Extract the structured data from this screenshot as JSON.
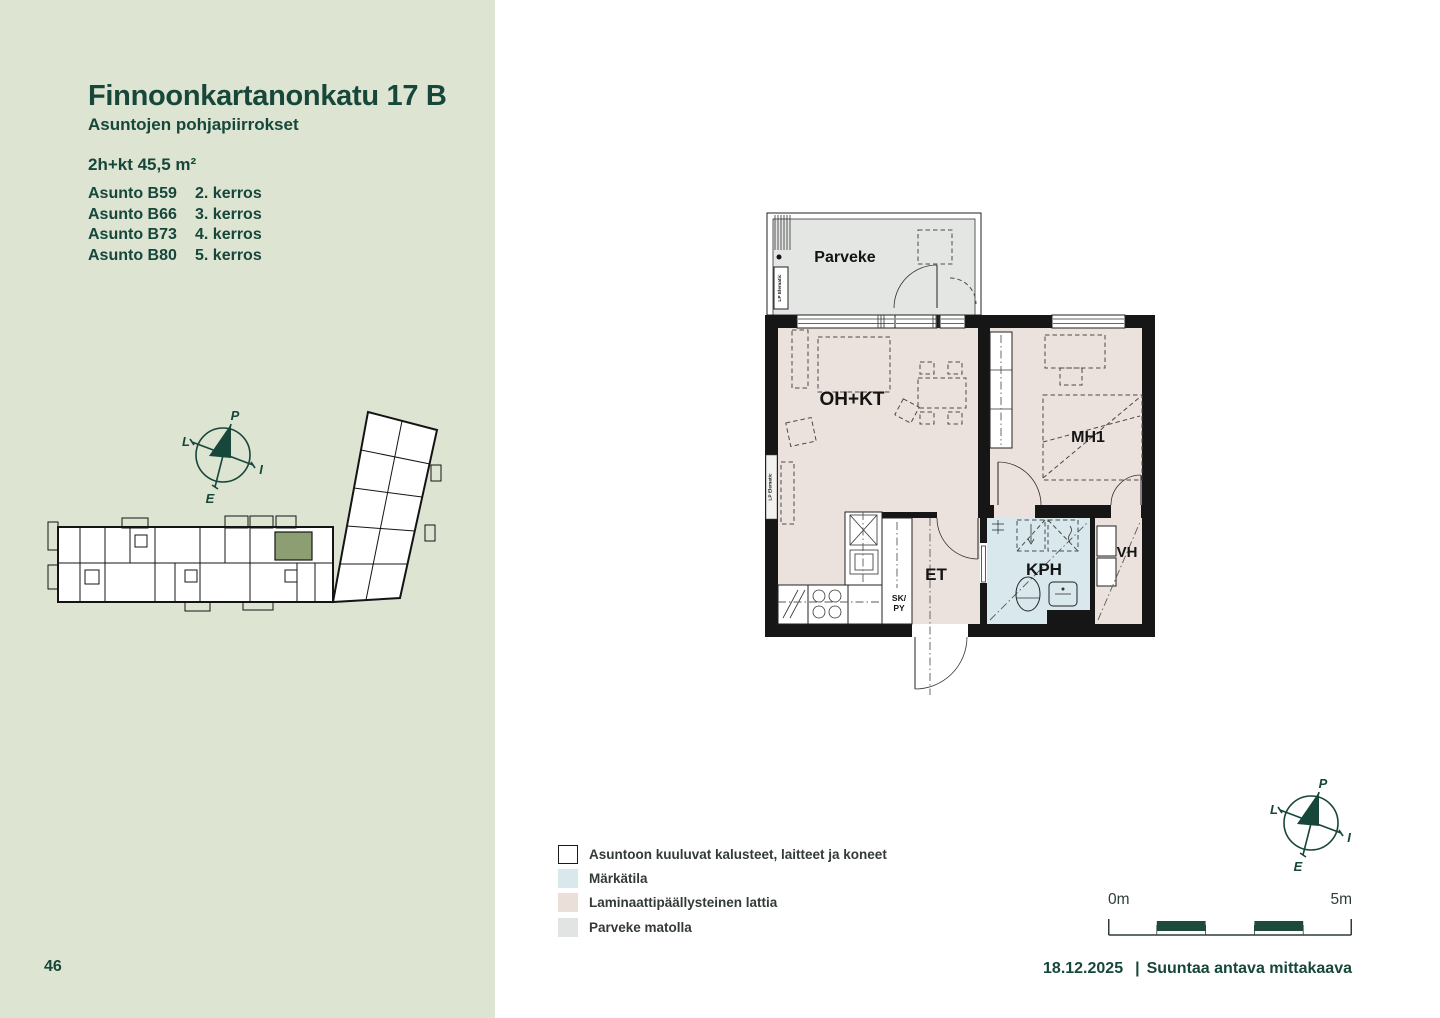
{
  "page": {
    "number": "46",
    "date": "18.12.2025",
    "separator": "|",
    "scale_note": "Suuntaa antava mittakaava"
  },
  "sidebar": {
    "title": "Finnoonkartanonkatu 17 B",
    "subtitle": "Asuntojen pohjapiirrokset",
    "apartment_type": "2h+kt 45,5 m²",
    "apartments": [
      {
        "name": "Asunto B59",
        "floor": "2. kerros"
      },
      {
        "name": "Asunto B66",
        "floor": "3. kerros"
      },
      {
        "name": "Asunto B73",
        "floor": "4. kerros"
      },
      {
        "name": "Asunto B80",
        "floor": "5. kerros"
      }
    ]
  },
  "floorplan": {
    "rooms": {
      "parveke": "Parveke",
      "oh_kt": "OH+KT",
      "mh1": "MH1",
      "et": "ET",
      "kph": "KPH",
      "vh": "VH",
      "sk": "SK/",
      "py": "PY"
    },
    "element_label": "LP Elematic"
  },
  "compass": {
    "north": "P",
    "west": "L",
    "east": "I",
    "south": "E"
  },
  "scalebar": {
    "start": "0m",
    "end": "5m"
  },
  "legend": {
    "items": [
      {
        "label": "Asuntoon kuuluvat kalusteet, laitteet ja koneet",
        "swatch": "#ffffff"
      },
      {
        "label": "Märkätila",
        "swatch": "#d8e8ec"
      },
      {
        "label": "Laminaattipäällysteinen lattia",
        "swatch": "#eadfd9"
      },
      {
        "label": "Parveke matolla",
        "swatch": "#e2e4e3"
      }
    ]
  },
  "colors": {
    "sidebar_bg": "#dde4d2",
    "accent_green": "#17463a",
    "wall_black": "#161616",
    "laminate_floor": "#ece2dd",
    "wet_room": "#d8e8ec",
    "balcony_gray": "#e4e6e4",
    "scalebar_fill": "#1d4a3c",
    "site_highlight": "#8d9f72"
  }
}
